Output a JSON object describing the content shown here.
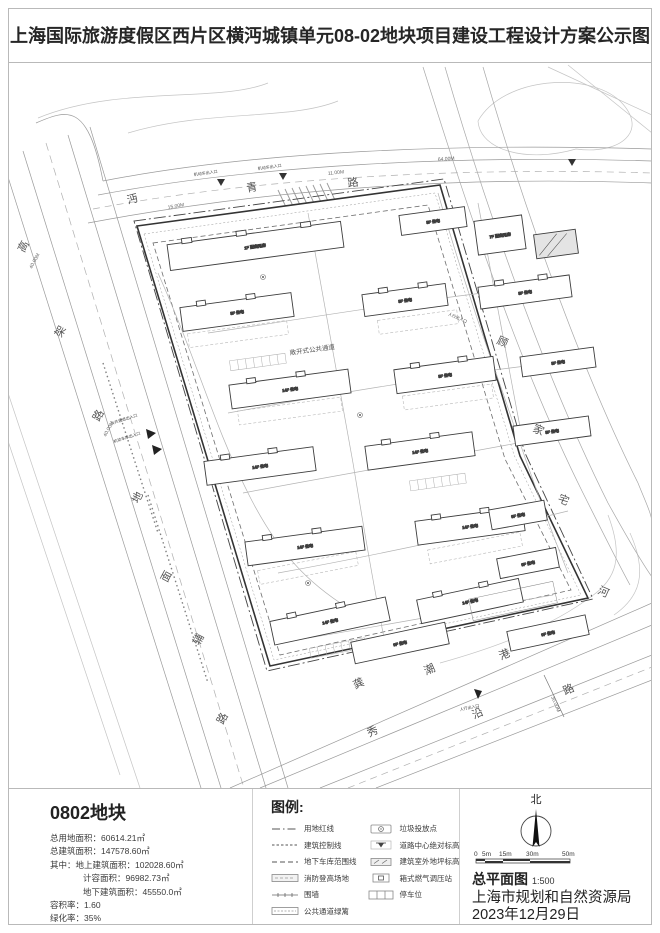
{
  "title": "上海国际旅游度假区西片区横沔城镇单元08-02地块项目建设工程设计方案公示图",
  "plan": {
    "road_top": {
      "c0": "沔",
      "c1": "青",
      "c2": "路"
    },
    "road_left": {
      "c0": "高",
      "c1": "架",
      "c2": "路"
    },
    "road_left_aux": {
      "c0": "地",
      "c1": "面",
      "c2": "辅",
      "c3": "路"
    },
    "river_right": {
      "c0": "顾",
      "c1": "家",
      "c2": "宅",
      "c3": "河"
    },
    "river_bottom": {
      "c0": "龚",
      "c1": "潮",
      "c2": "港"
    },
    "road_bottom": {
      "c0": "秀",
      "c1": "沿",
      "c2": "路"
    },
    "dims": {
      "w40": "40.00M",
      "w40b": "40.00M",
      "w30": "30.00M",
      "d15": "15.00M",
      "d11": "11.00M",
      "d64": "64.00M"
    },
    "annotations": {
      "passage": "敞开式公共通道",
      "ent_vehicle": "机动车出入口",
      "ent_ped": "人行出入口",
      "ent_public": "公共通道出入口",
      "ent_garage": "机动车库出入口"
    },
    "building_labels": [
      "1F 配套用房",
      "9F 住宅",
      "7F 配套用房",
      "9F 住宅",
      "9F 住宅",
      "9F 住宅",
      "14F 住宅",
      "9F 住宅",
      "9F 住宅",
      "14F 住宅",
      "14F 住宅",
      "9F 住宅",
      "14F 住宅",
      "14F 住宅",
      "9F 住宅",
      "14F 住宅",
      "14F 住宅",
      "9F 住宅",
      "9F 住宅",
      "9F 住宅"
    ]
  },
  "footer": {
    "parcel": {
      "title": "0802地块",
      "stats": [
        "总用地面积：60614.21㎡",
        "总建筑面积：147578.60㎡",
        "其中：地上建筑面积：102028.60㎡",
        "计容面积：96982.73㎡",
        "地下建筑面积：45550.0㎡",
        "容积率：1.60",
        "绿化率：35%"
      ]
    },
    "legend": {
      "title": "图例:",
      "left": [
        "用地红线",
        "建筑控制线",
        "地下车库范围线",
        "消防登高场地",
        "围墙",
        "公共通道绿篱"
      ],
      "right": [
        "垃圾投放点",
        "道路中心绝对标高",
        "建筑室外地坪标高",
        "箱式燃气调压站",
        "停车位"
      ]
    },
    "info": {
      "north": "北",
      "scale_ticks": [
        "0",
        "5m",
        "15m",
        "30m",
        "50m"
      ],
      "drawing_name": "总平面图",
      "scale": "1:500",
      "agency": "上海市规划和自然资源局",
      "date": "2023年12月29日"
    }
  }
}
